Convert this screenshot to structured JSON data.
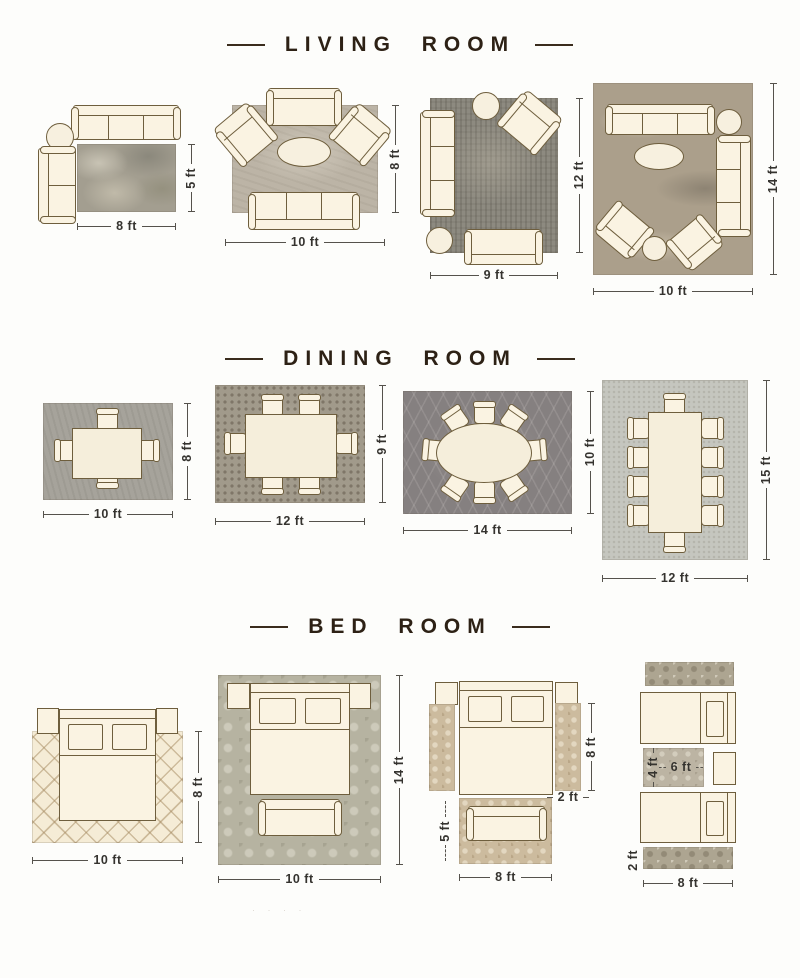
{
  "palette": {
    "background": "#fdfdfb",
    "title_text": "#2d2115",
    "furniture_fill": "#faf3e2",
    "furniture_outline": "#6e5e3d",
    "dimension_text": "#35332f"
  },
  "sections": {
    "living": {
      "title": "LIVING ROOM",
      "layouts": [
        {
          "width": "8 ft",
          "depth": "5 ft",
          "furniture": [
            "sofa-3-seat",
            "round-side-table",
            "lounge-chair",
            "rug"
          ]
        },
        {
          "width": "10 ft",
          "depth": "8 ft",
          "furniture": [
            "loveseat",
            "armchair",
            "armchair",
            "oval-coffee-table",
            "sofa-3-seat",
            "rug"
          ]
        },
        {
          "width": "9 ft",
          "depth": "12 ft",
          "furniture": [
            "sofa-3-seat",
            "round-side-table",
            "armchair",
            "round-side-table",
            "loveseat",
            "rug"
          ]
        },
        {
          "width": "10 ft",
          "depth": "14 ft",
          "furniture": [
            "sofa-3-seat",
            "round-side-table",
            "oval-coffee-table",
            "sofa-3-seat",
            "armchair",
            "armchair",
            "round-side-table",
            "rug"
          ]
        }
      ]
    },
    "dining": {
      "title": "DINING ROOM",
      "layouts": [
        {
          "width": "10 ft",
          "depth": "8 ft",
          "furniture": [
            "dining-table",
            "4-chairs",
            "rug"
          ]
        },
        {
          "width": "12 ft",
          "depth": "9 ft",
          "furniture": [
            "dining-table",
            "6-chairs",
            "rug"
          ]
        },
        {
          "width": "14 ft",
          "depth": "10 ft",
          "furniture": [
            "oval-dining-table",
            "8-chairs",
            "rug"
          ]
        },
        {
          "width": "12 ft",
          "depth": "15 ft",
          "furniture": [
            "long-dining-table",
            "10-chairs",
            "rug"
          ]
        }
      ]
    },
    "bedroom": {
      "title": "BED ROOM",
      "layouts": [
        {
          "width": "10 ft",
          "depth": "8 ft",
          "furniture": [
            "queen-bed",
            "nightstand",
            "nightstand",
            "rug"
          ]
        },
        {
          "width": "10 ft",
          "depth": "14 ft",
          "furniture": [
            "queen-bed",
            "nightstand",
            "nightstand",
            "bench",
            "rug"
          ]
        },
        {
          "runner_length": "8 ft",
          "runner_width": "2 ft",
          "foot_rug_depth": "5 ft",
          "foot_rug_width": "8 ft",
          "furniture": [
            "queen-bed",
            "nightstand",
            "nightstand",
            "runner-rug",
            "runner-rug",
            "bench",
            "foot-rug"
          ]
        },
        {
          "accent_rug_depth": "4 ft",
          "accent_rug_width": "6 ft",
          "runner_width": "2 ft",
          "runner_length": "8 ft",
          "furniture": [
            "twin-bed",
            "twin-bed",
            "nightstand",
            "runner-rug",
            "runner-rug",
            "accent-rug"
          ]
        }
      ]
    }
  },
  "watermark": "· · · ·"
}
